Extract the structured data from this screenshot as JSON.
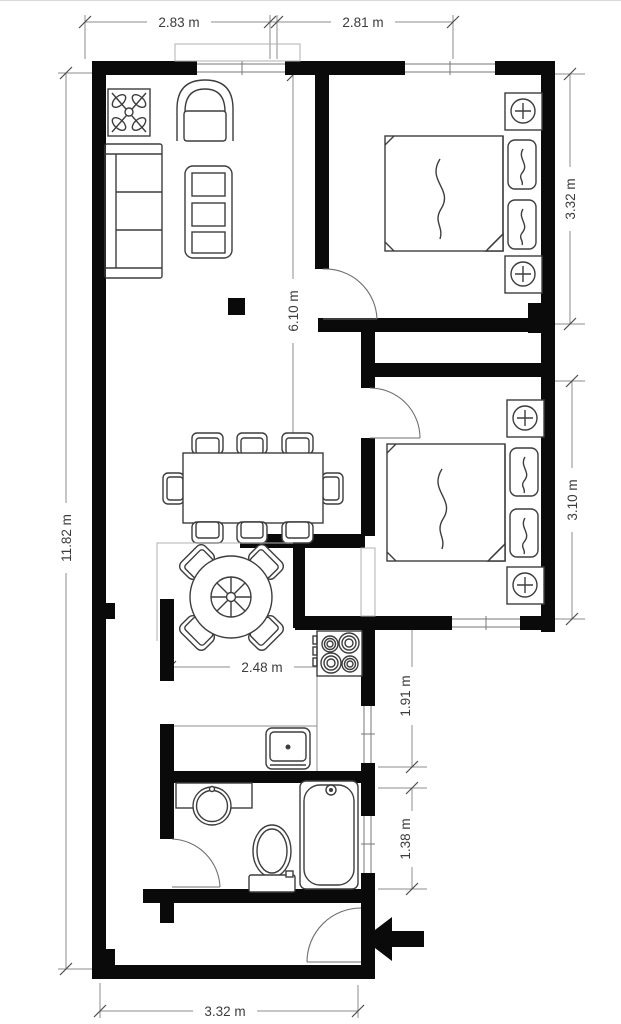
{
  "floor_plan": {
    "title": "two-bedroom apartment floor plan",
    "dimensions": {
      "top_left_width": "2.83 m",
      "top_right_width": "2.81 m",
      "left_height": "11.82 m",
      "living_interior_height": "6.10 m",
      "bedroom1_height": "3.32 m",
      "bedroom2_height": "3.10 m",
      "kitchen_width": "2.48 m",
      "kitchen_right_height": "1.91 m",
      "bathroom_height": "1.38 m",
      "bottom_width": "3.32 m"
    },
    "colors": {
      "wall": "#0a0a0a",
      "furniture_line": "#3d3d3d",
      "dimension_line": "#8c8c8c",
      "dimension_text": "#3c3c3c",
      "background": "#ffffff"
    },
    "rooms": {
      "living_room": [
        "potted-plant-icon",
        "armchair-icon",
        "sofa-icon",
        "coffee-table-icon",
        "column-icon"
      ],
      "dining_area": [
        "dining-table-icon",
        "dining-chair-icon x8"
      ],
      "breakfast_nook": [
        "round-table-icon",
        "nook-chair-icon x4"
      ],
      "kitchen": [
        "stove-icon",
        "kitchen-sink-icon",
        "counter-icon"
      ],
      "bathroom": [
        "wash-basin-icon",
        "toilet-icon",
        "bathtub-icon"
      ],
      "bedroom_1": [
        "double-bed-icon",
        "pillow-icon x2",
        "nightstand-lamp-icon x2"
      ],
      "bedroom_2": [
        "double-bed-icon",
        "pillow-icon x2",
        "nightstand-lamp-icon x2"
      ],
      "entry": [
        "entry-arrow-icon",
        "entry-door-icon"
      ]
    }
  }
}
